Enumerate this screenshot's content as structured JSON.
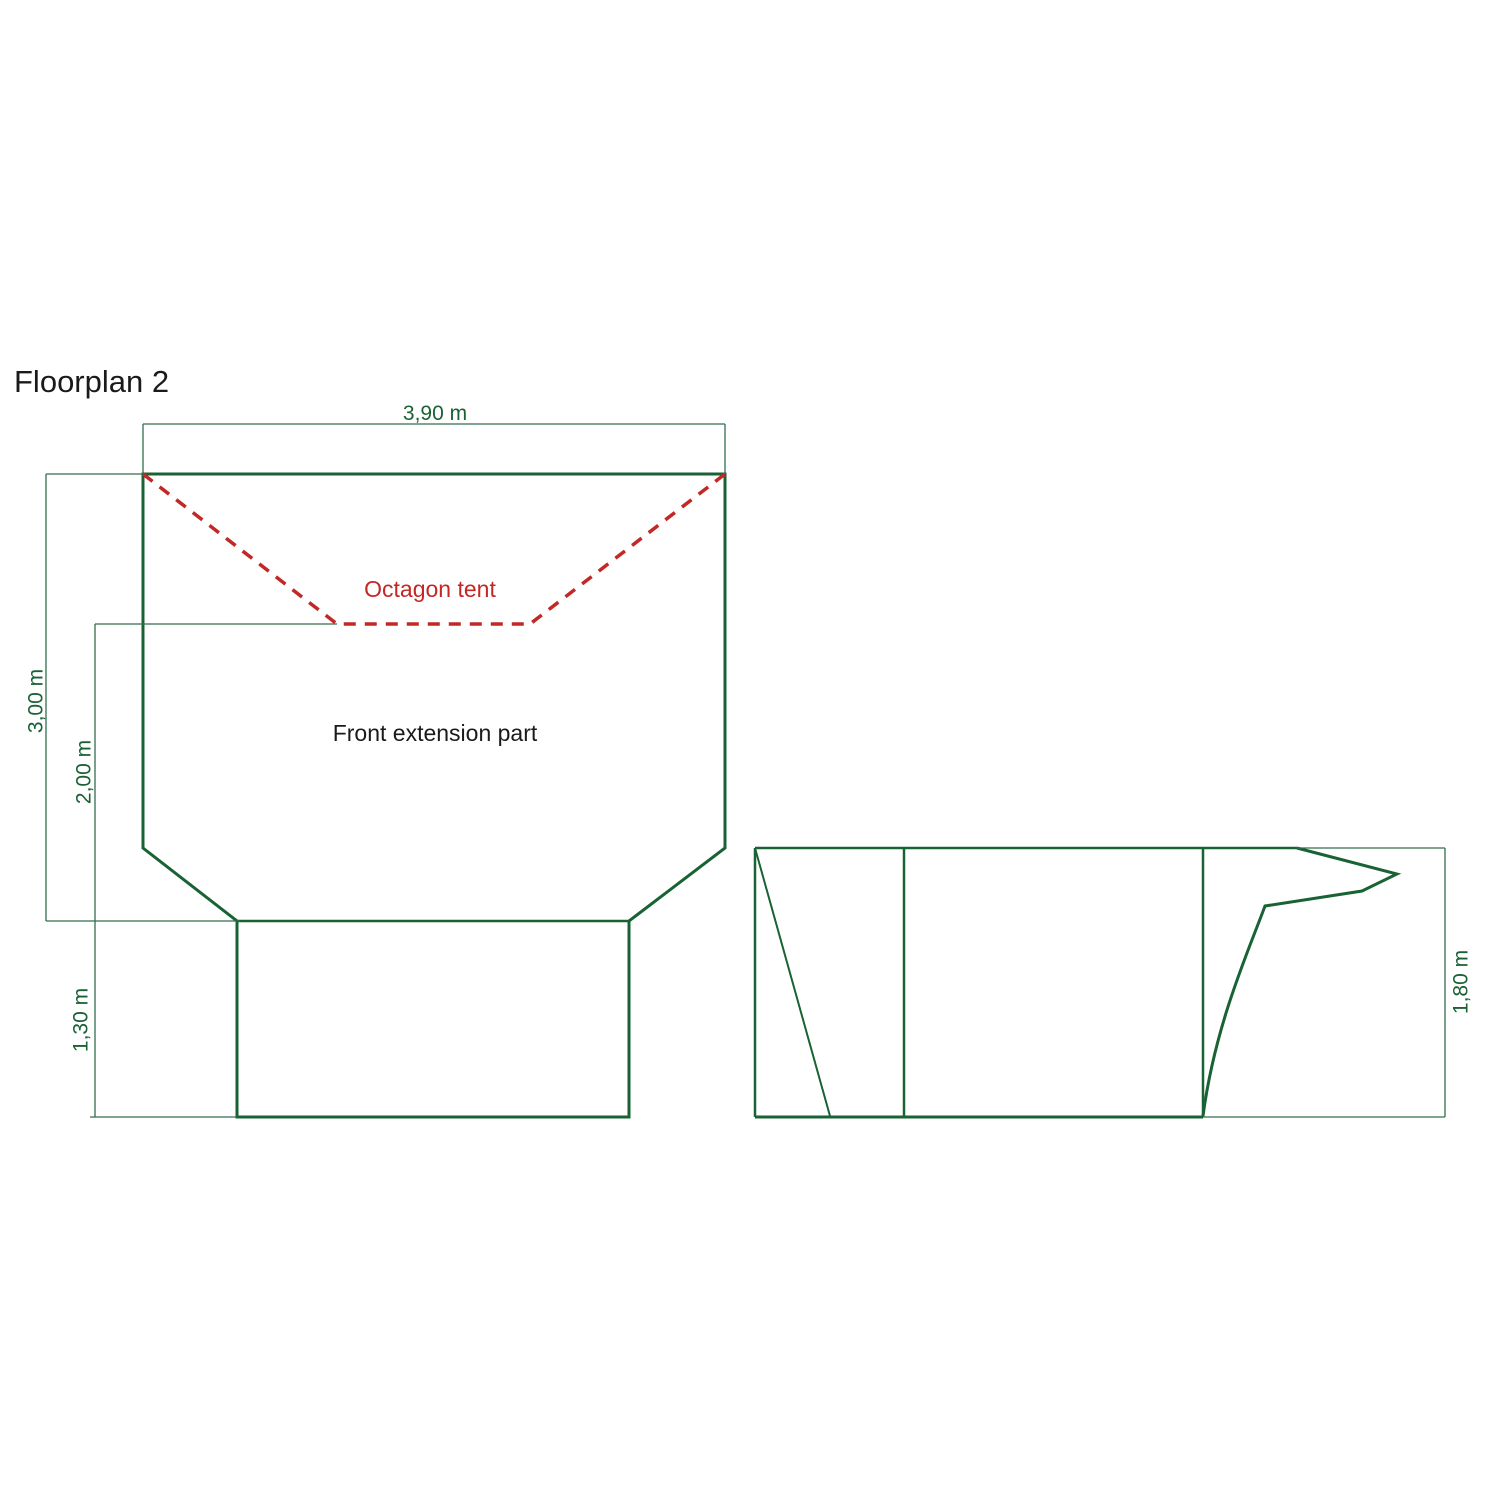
{
  "title": "Floorplan 2",
  "colors": {
    "outline": "#186234",
    "dimension": "#336e4e",
    "dashed": "#c22826",
    "text": "#1a1a1a"
  },
  "floorplan": {
    "tent_label": "Octagon tent",
    "extension_label": "Front extension part",
    "dimensions": {
      "width": "3,90 m",
      "total_depth": "3,00 m",
      "tent_depth": "2,00 m",
      "extension_depth": "1,30 m"
    }
  },
  "side_view": {
    "dimensions": {
      "height": "1,80 m"
    }
  }
}
